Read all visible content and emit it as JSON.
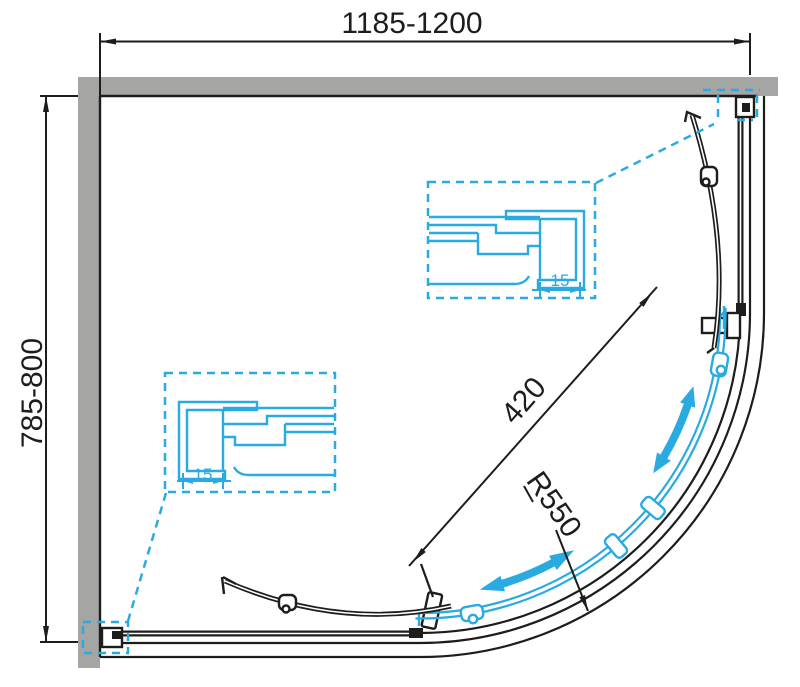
{
  "drawing": {
    "type": "technical-plan",
    "subject": "quadrant-shower-enclosure-top-view",
    "dimensions": {
      "width": "1185-1200",
      "depth": "785-800",
      "door_opening": "420",
      "door_radius": "R550",
      "right_profile_adjustment": "15",
      "left_profile_adjustment": "15"
    },
    "colors": {
      "wall_fill": "#a5a5a4",
      "line": "#1d1d1b",
      "accent": "#29abe2",
      "background": "#ffffff"
    },
    "icons": {
      "slide_direction": "double-headed-arrow"
    }
  }
}
